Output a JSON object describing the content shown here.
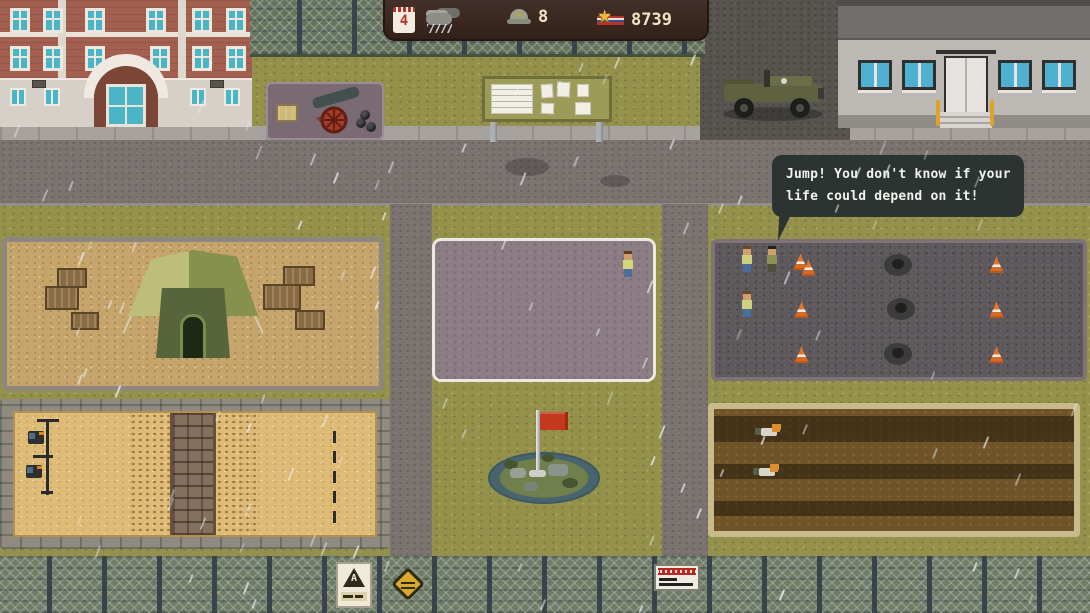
{
  "hud": {
    "day": "4",
    "soldiers_count": "8",
    "stars_count": "8739",
    "icons": [
      "calendar-icon",
      "rain-cloud-icon",
      "helmet-icon",
      "star-medal-icon"
    ]
  },
  "speech_bubble": {
    "line1": "Jump! You don't know if your",
    "line2": "life could depend on it!",
    "speaker": "drill-sergeant"
  },
  "signs": {
    "warning_sign_letter": "A"
  },
  "weather": {
    "condition": "rain"
  },
  "colors": {
    "hud_background": "#36241a",
    "bubble_background": "#2c3431",
    "flag_red": "#c4391d",
    "cone_orange": "#e2762c",
    "grass": "#94914c",
    "road": "#7b7370",
    "parade_ground": "#8c7c84",
    "sand": "#debb76",
    "mud": "#6e5428",
    "brick_building": "#a35f4f",
    "hq_building_wall": "#bcb8b4"
  }
}
